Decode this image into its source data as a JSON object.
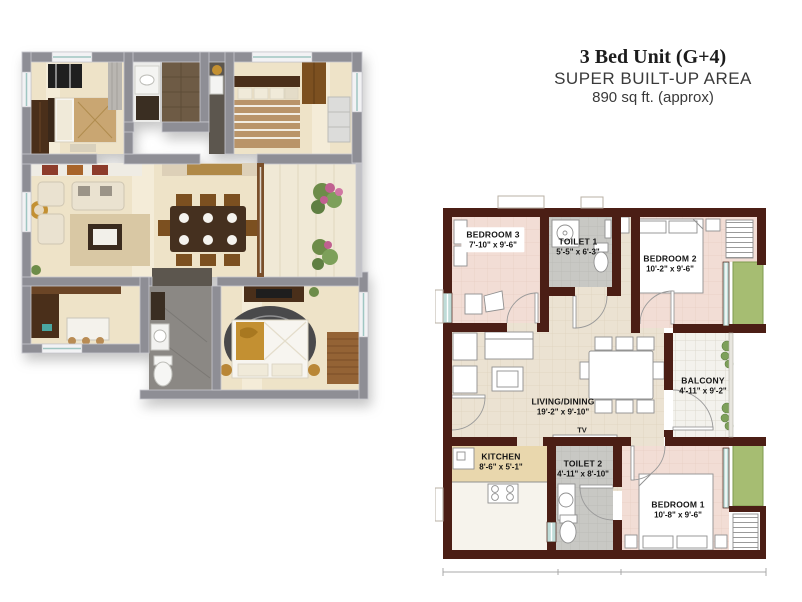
{
  "title": {
    "line1": "3 Bed Unit (G+4)",
    "line2": "SUPER BUILT-UP AREA",
    "line3": "890 sq ft. (approx)"
  },
  "plan2d": {
    "tv_label": "TV",
    "rooms": [
      {
        "id": "bedroom-3",
        "name": "BEDROOM 3",
        "dims": "7'-10\" x 9'-6\""
      },
      {
        "id": "toilet-1",
        "name": "TOILET 1",
        "dims": "5'-5\" x 6'-3\""
      },
      {
        "id": "bedroom-2",
        "name": "BEDROOM 2",
        "dims": "10'-2\" x 9'-6\""
      },
      {
        "id": "balcony",
        "name": "BALCONY",
        "dims": "4'-11\" x 9'-2\""
      },
      {
        "id": "living-dining",
        "name": "LIVING/DINING",
        "dims": "19'-2\" x 9'-10\""
      },
      {
        "id": "kitchen",
        "name": "KITCHEN",
        "dims": "8'-6\" x 5'-1\""
      },
      {
        "id": "toilet-2",
        "name": "TOILET 2",
        "dims": "4'-11\" x 8'-10\""
      },
      {
        "id": "bedroom-1",
        "name": "BEDROOM 1",
        "dims": "10'-8\" x 9'-6\""
      }
    ]
  },
  "colors": {
    "wall_2d": "#4b1e15",
    "bedroom_floor": "#f2ddd5",
    "living_floor": "#ebe2d2",
    "toilet_floor": "#c8c8c4",
    "kitchen_floor": "#e9d7ad",
    "balcony_floor": "#f3f2ed",
    "planter_green": "#a6bd72",
    "window_glass": "#bfdcd8",
    "wall_3d": "#8e8e95",
    "floor_3d": "#eee3c8"
  }
}
